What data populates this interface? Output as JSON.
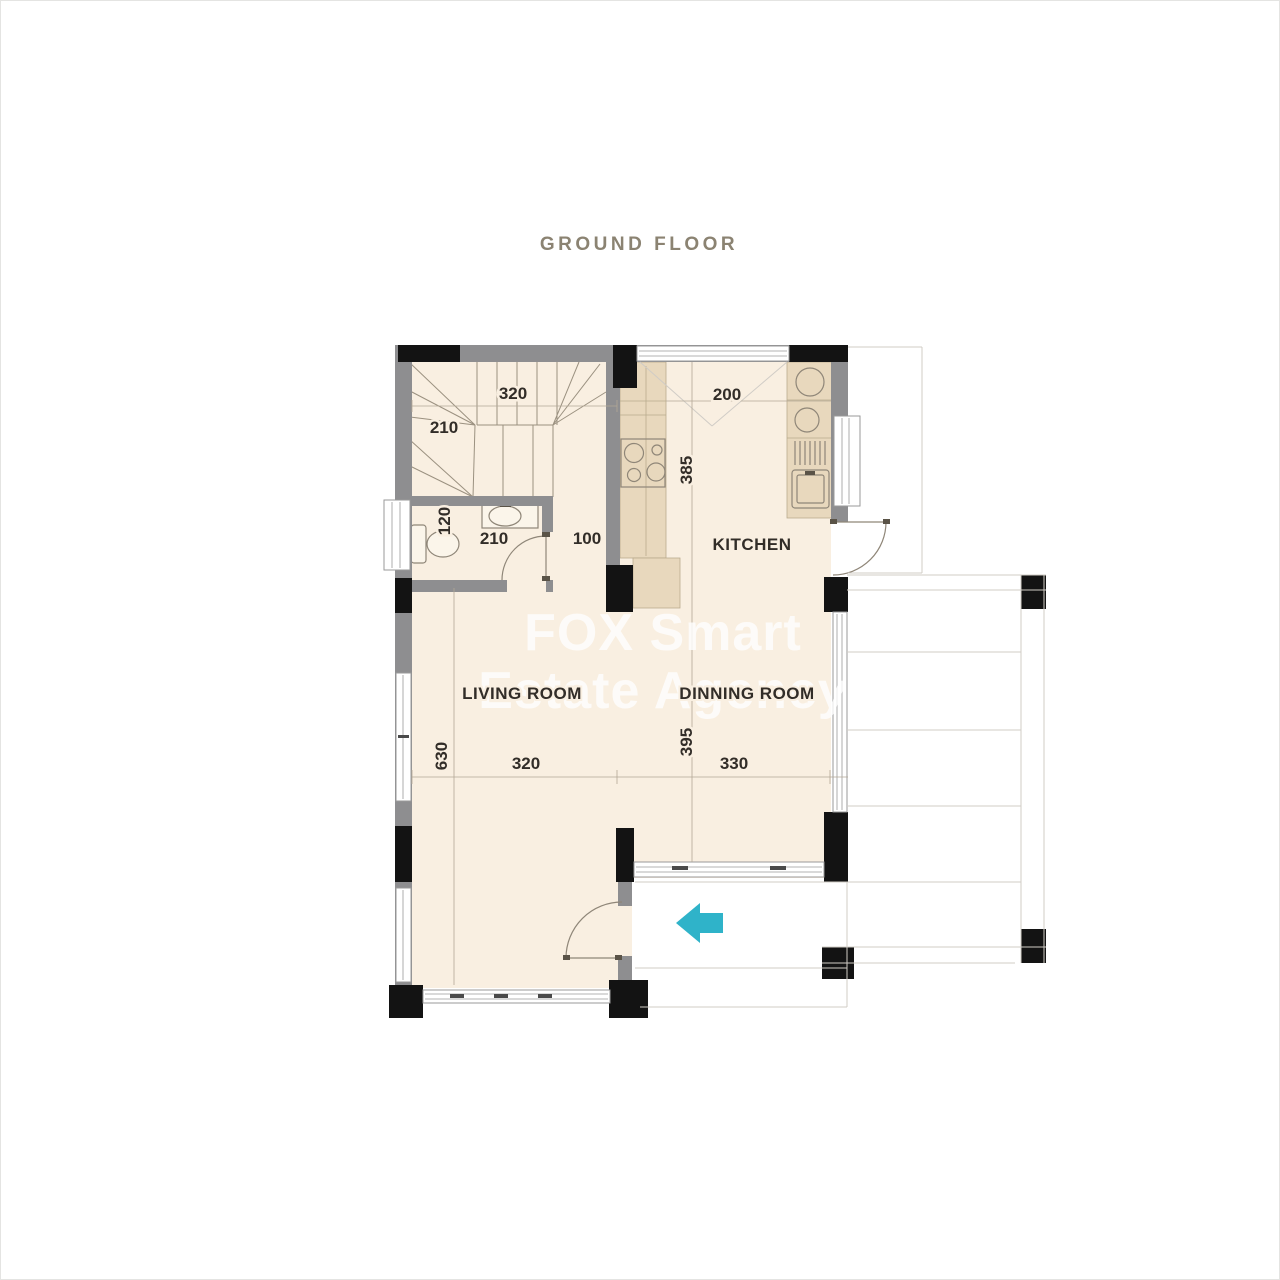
{
  "title": "GROUND FLOOR",
  "watermark": {
    "line1": "FOX Smart",
    "line2": "Estate Agency"
  },
  "rooms": {
    "kitchen": "KITCHEN",
    "living_room": "LIVING ROOM",
    "dinning_room": "DINNING ROOM"
  },
  "dimensions": {
    "stair_width": "320",
    "stair_depth": "210",
    "kitchen_width": "200",
    "kitchen_depth": "385",
    "wc_depth": "120",
    "wc_width": "210",
    "hall_width": "100",
    "living_depth": "630",
    "living_width": "320",
    "dinning_depth": "395",
    "dinning_width": "330"
  },
  "icons": {
    "entrance_arrow": "left-arrow"
  },
  "colors": {
    "floor": "#f9efe1",
    "counter": "#e8d8bd",
    "wall": "#8e8e90",
    "column": "#131313",
    "line": "#9b9180",
    "deck_line": "#d0ccc6",
    "door": "#8f8678",
    "label": "#322d28",
    "title": "#8b8372",
    "arrow": "#2fb3c9",
    "watermark": "#ffffff"
  }
}
